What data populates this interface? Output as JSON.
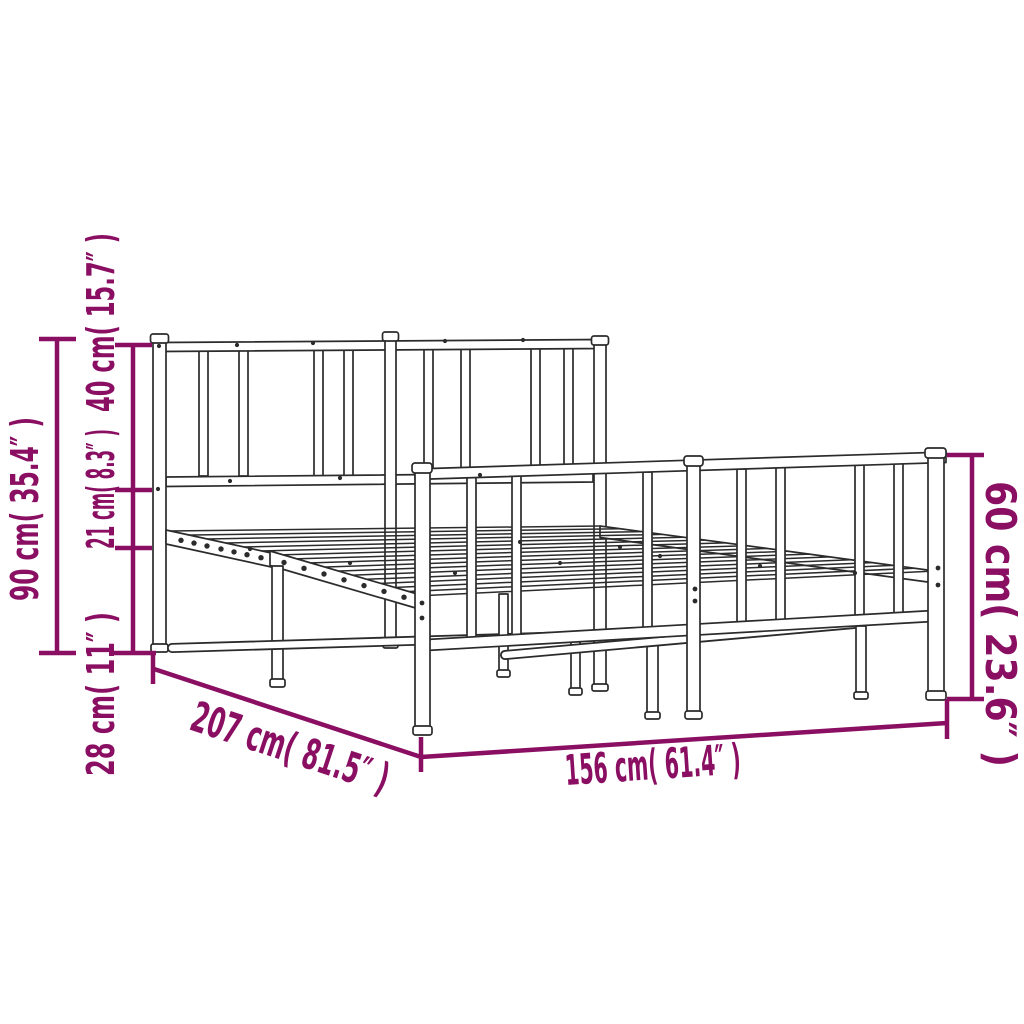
{
  "page": {
    "background": "#ffffff"
  },
  "colors": {
    "dimension": "#8a0f63",
    "drawing": "#2b2b2b"
  },
  "figure": {
    "description": "Metal bed frame with headboard and footboard, perspective line drawing with dimension callouts",
    "dimensions": {
      "total_height": "90 cm( 35.4″ )",
      "headboard_section": "40 cm( 15.7″ )",
      "under_headboard": "21 cm( 8.3″ )",
      "base_height": "28 cm( 11″ )",
      "length": "207 cm( 81.5″ )",
      "width": "156 cm( 61.4″ )",
      "footboard_height": "60 cm( 23.6″ )"
    }
  }
}
